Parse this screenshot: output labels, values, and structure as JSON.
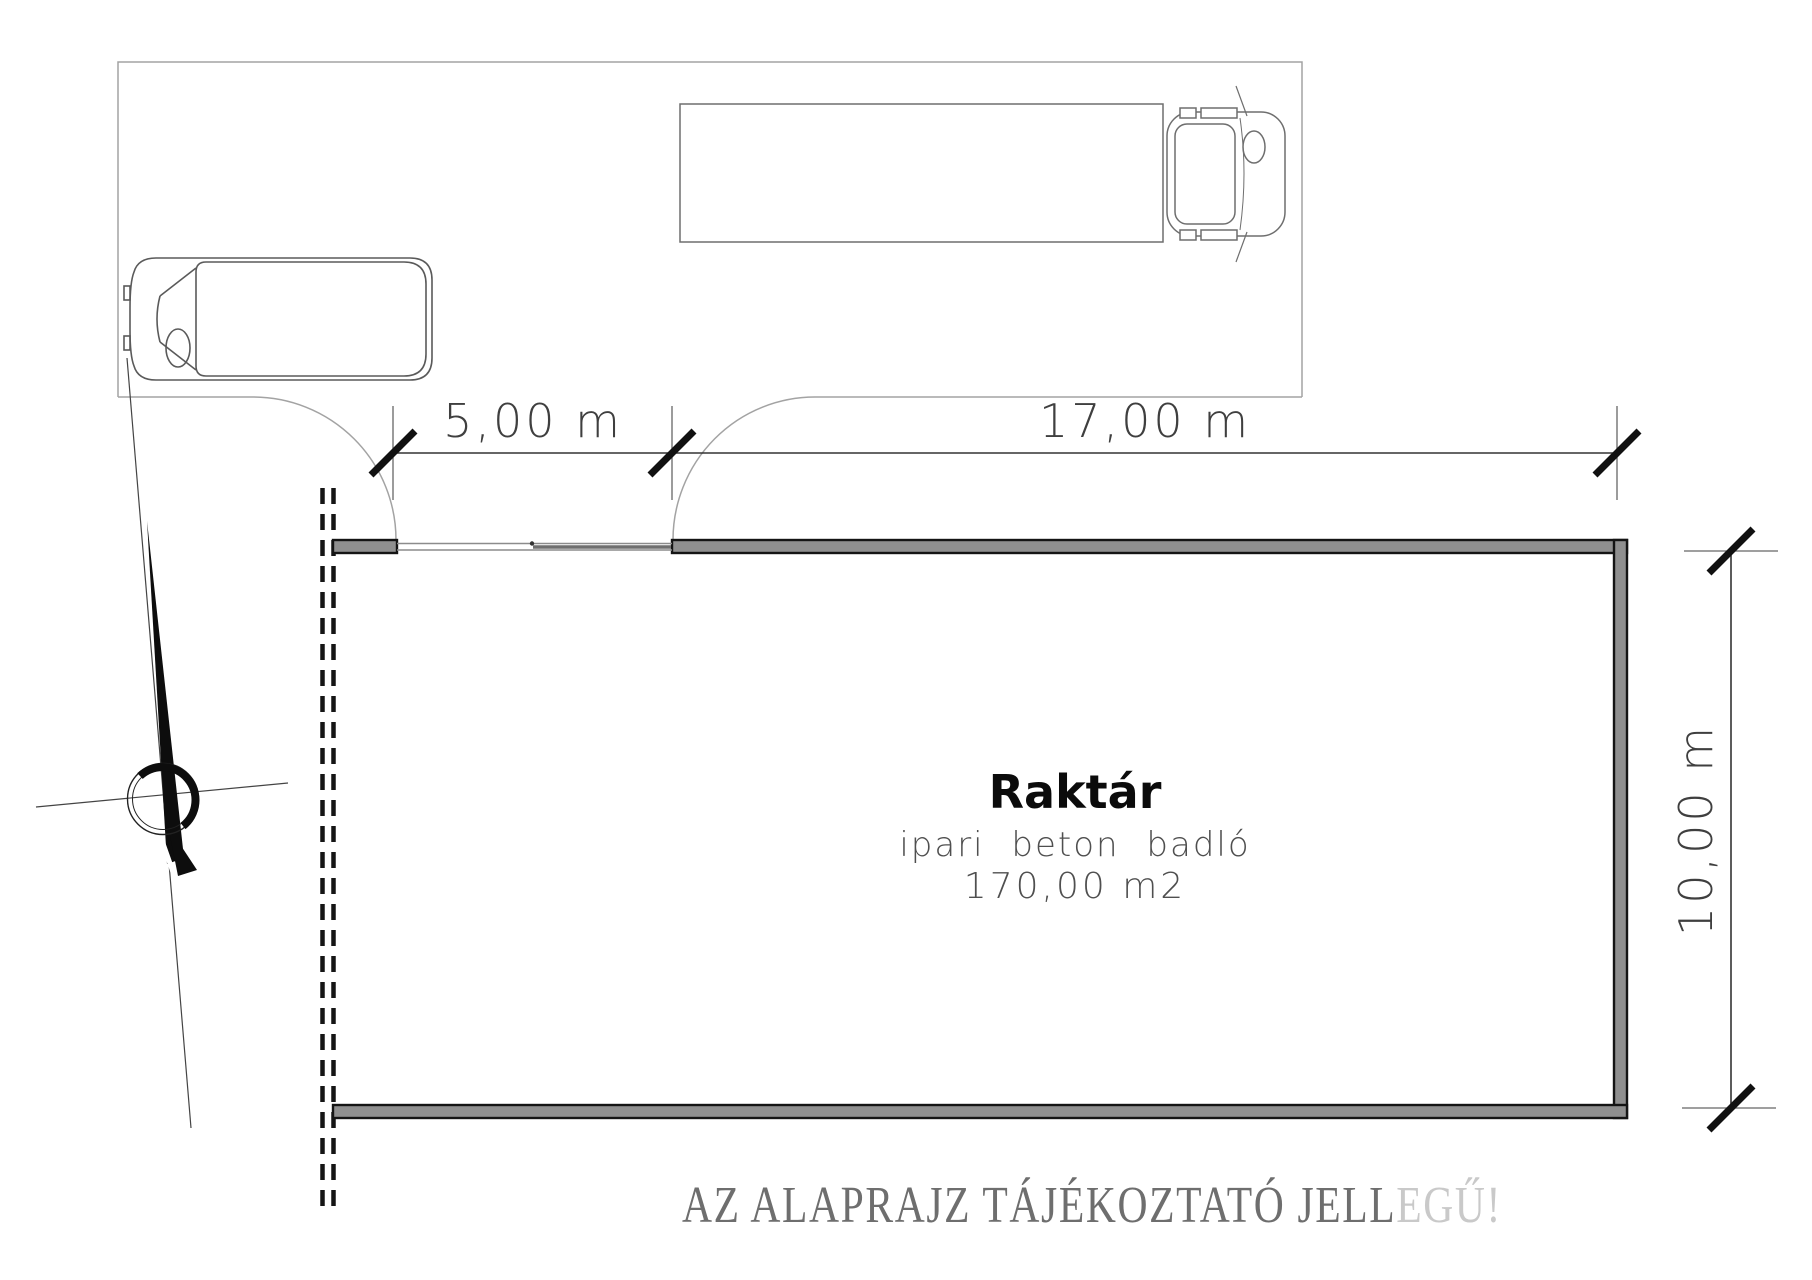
{
  "scene": {
    "room": {
      "name": "Raktár",
      "floor_note": "ipari beton badló",
      "area": "170,00 m2"
    },
    "dimensions": {
      "gate_width": "5,00 m",
      "hall_width": "17,00 m",
      "hall_depth": "10,00 m"
    },
    "disclaimer": {
      "text": "AZ ALAPRAJZ TÁJÉKOZTATÓ JELL",
      "faded_tail": "EGŰ!"
    },
    "colors": {
      "wall_fill": "#8f8f8f",
      "wall_edge": "#141414",
      "dimension_line": "#333333",
      "dimension_text": "#3f3f3f",
      "room_text": "#0b0b0b",
      "room_subtext": "#4f4f4f",
      "parking_line": "#a3a3a3",
      "disclaimer_text": "#6e6e6e",
      "disclaimer_faded": "#c9c9c9"
    }
  }
}
